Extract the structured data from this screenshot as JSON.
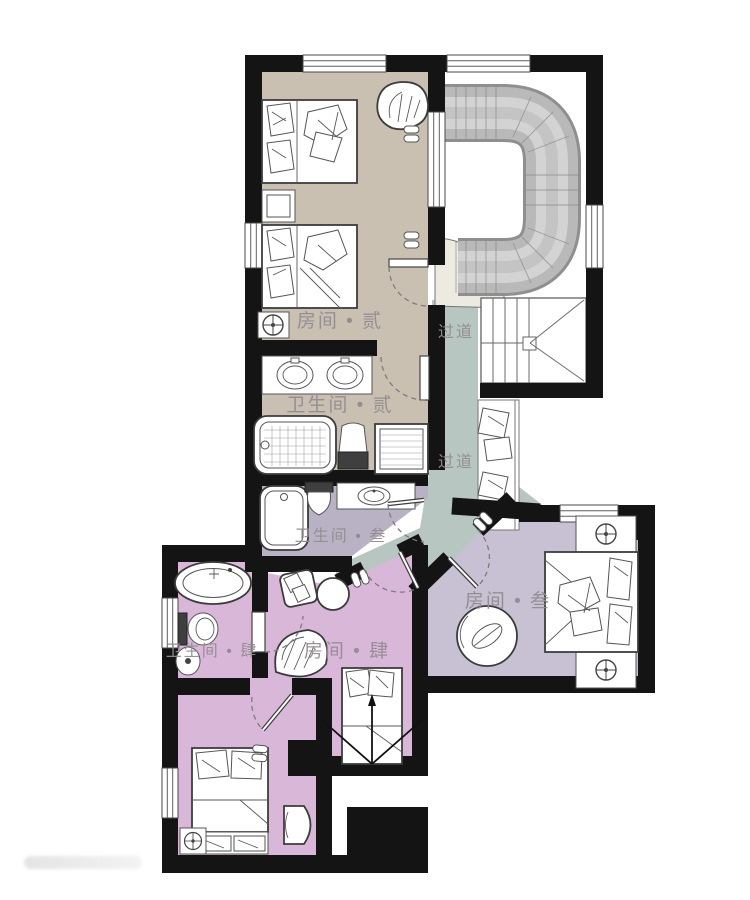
{
  "plan": {
    "labels": {
      "room2": "房间 • 贰",
      "bath2": "卫生间 • 贰",
      "corridor_upper": "过道",
      "corridor_lower": "过道",
      "bath3": "卫生间 • 叁",
      "room3": "房间 • 叁",
      "bath4": "卫生间 • 肆",
      "room4": "房间 • 肆"
    },
    "colors": {
      "wall": "#141414",
      "room2": "#c9c0b1",
      "corridor": "#b7c6c0",
      "room3": "#c7c1d3",
      "bath3": "#b9b2c4",
      "room4": "#d8b7d9",
      "fan": "#edeae2",
      "slide_edge": "#8f8f8f",
      "slide_body": "#b9b9b9",
      "slide_light": "#d3d3d3",
      "slide_mid": "#c4c4c4",
      "labeltext": "#938d92"
    }
  }
}
